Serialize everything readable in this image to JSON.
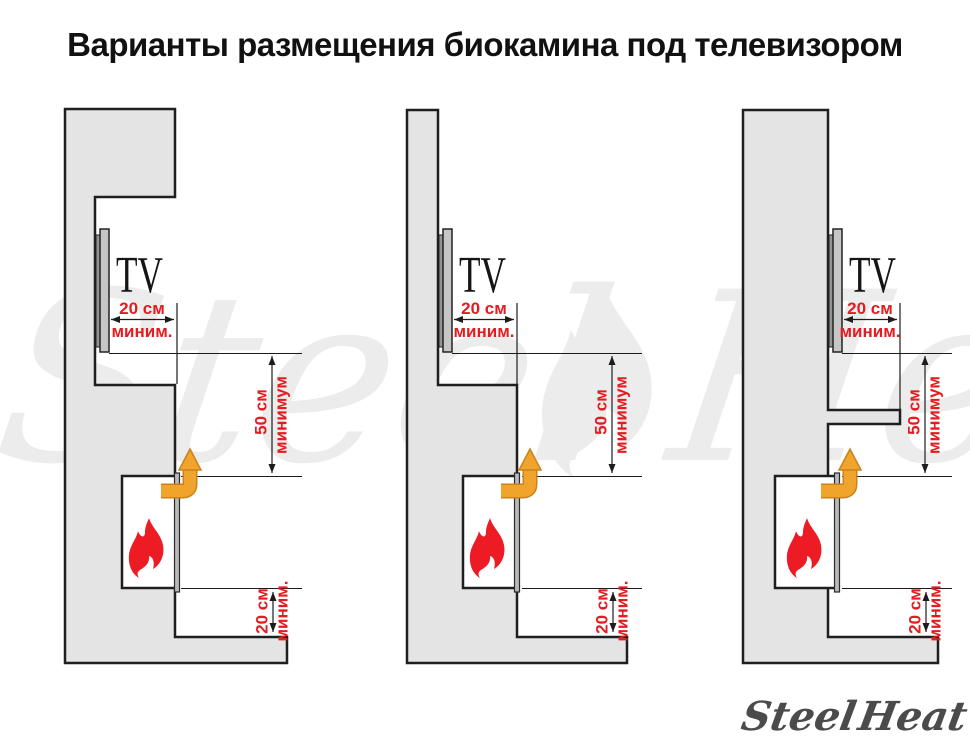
{
  "title": "Варианты размещения биокамина под телевизором",
  "watermark": {
    "steel": "Steel",
    "heat": "Heat"
  },
  "logo": {
    "steel": "Steel",
    "heat": "Heat"
  },
  "colors": {
    "accent_red": "#e41b1f",
    "flame_red": "#ed1c24",
    "arrow_orange": "#f0a42c",
    "arrow_orange_outline": "#c9821d",
    "wall_fill": "#e4e4e4",
    "outline_dark": "#1f1f1f",
    "watermark_gray": "#ececec",
    "logo_text_gray": "#4b4b4b"
  },
  "diagrams": [
    {
      "tv_label": "TV",
      "front_clearance": {
        "value": "20 см",
        "qualifier": "миним."
      },
      "top_clearance": {
        "value": "50 см",
        "qualifier": "минимум"
      },
      "bottom_clearance": {
        "value": "20 см",
        "qualifier": "миним."
      }
    },
    {
      "tv_label": "TV",
      "front_clearance": {
        "value": "20 см",
        "qualifier": "миним."
      },
      "top_clearance": {
        "value": "50 см",
        "qualifier": "минимум"
      },
      "bottom_clearance": {
        "value": "20 см",
        "qualifier": "миним."
      }
    },
    {
      "tv_label": "TV",
      "front_clearance": {
        "value": "20 см",
        "qualifier": "миним."
      },
      "top_clearance": {
        "value": "50 см",
        "qualifier": "минимум"
      },
      "bottom_clearance": {
        "value": "20 см",
        "qualifier": "миним."
      }
    }
  ]
}
